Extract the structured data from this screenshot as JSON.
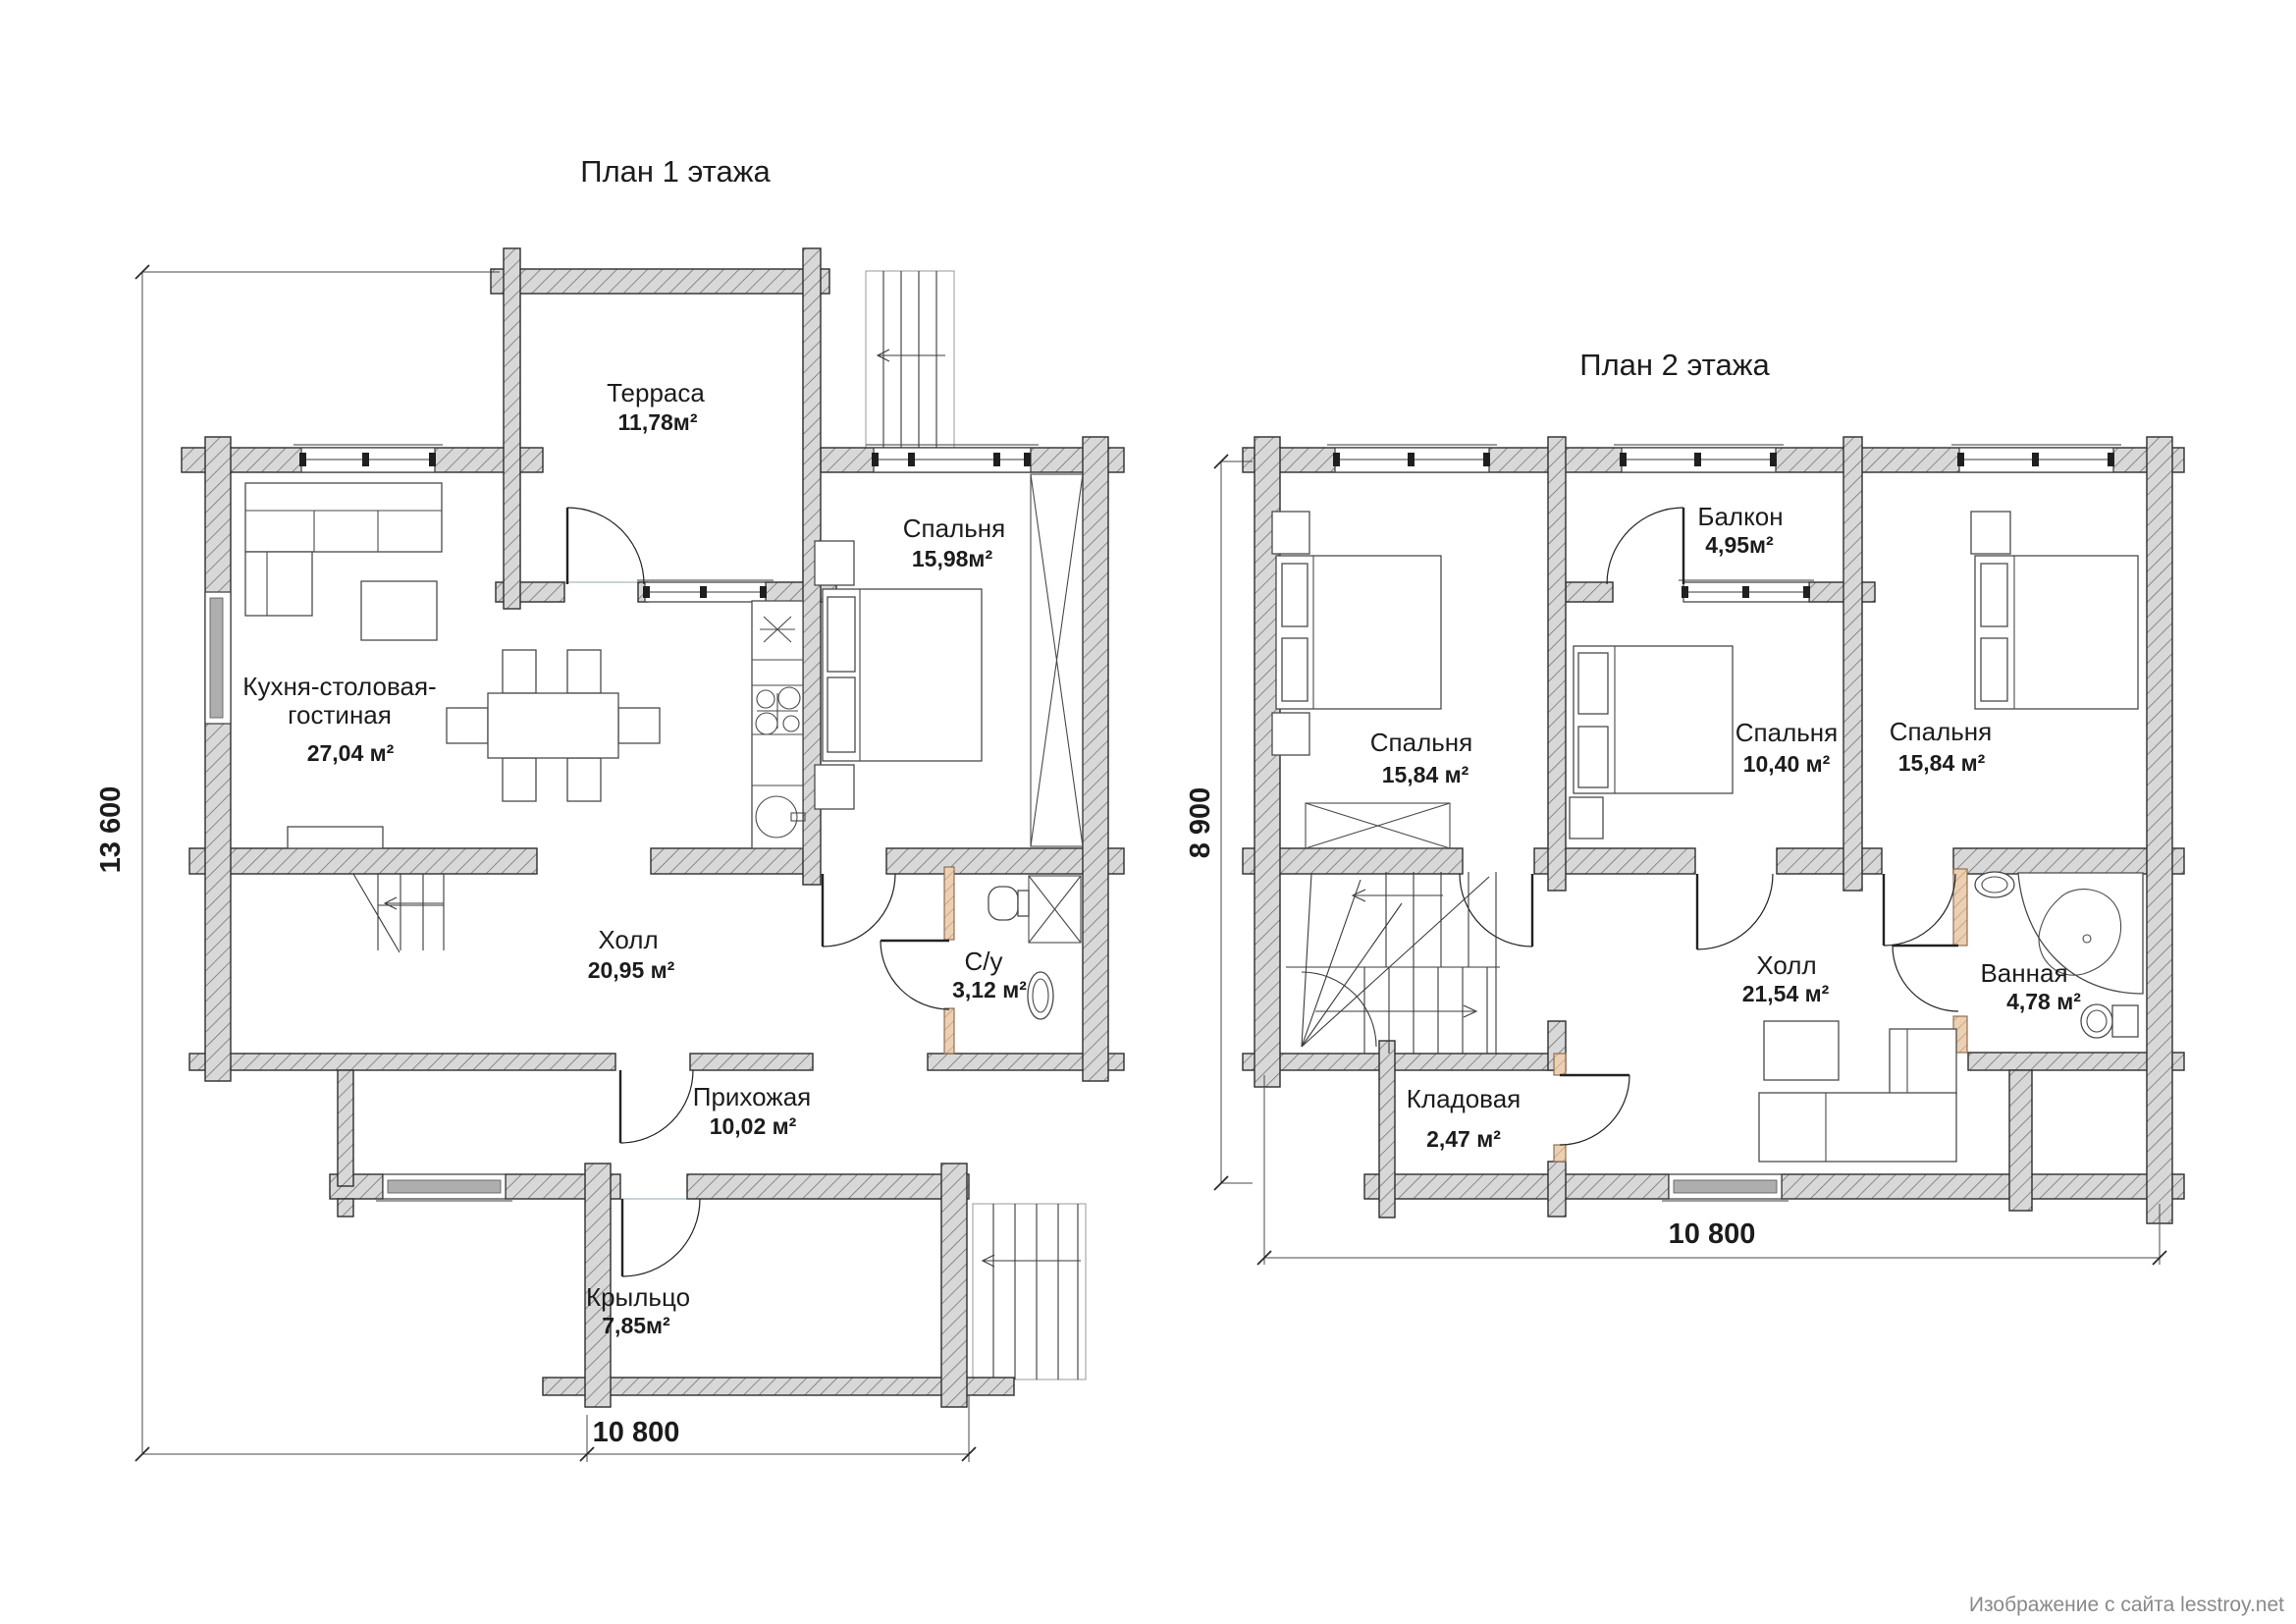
{
  "document": {
    "watermark": "Изображение с сайта lesstroy.net"
  },
  "floor1": {
    "title": "План 1 этажа",
    "rooms": {
      "terrace": {
        "name": "Терраса",
        "area": "11,78м²"
      },
      "bedroom": {
        "name": "Спальня",
        "area": "15,98м²"
      },
      "kitchen": {
        "name_line1": "Кухня-столовая-",
        "name_line2": "гостиная",
        "area": "27,04 м²"
      },
      "hall": {
        "name": "Холл",
        "area": "20,95 м²"
      },
      "wc": {
        "name": "С/у",
        "area": "3,12 м²"
      },
      "entry": {
        "name": "Прихожая",
        "area": "10,02 м²"
      },
      "porch": {
        "name": "Крыльцо",
        "area": "7,85м²"
      }
    },
    "dimensions": {
      "height": "13 600",
      "width": "10 800"
    }
  },
  "floor2": {
    "title": "План 2 этажа",
    "rooms": {
      "balcony": {
        "name": "Балкон",
        "area": "4,95м²"
      },
      "bedroom_left": {
        "name": "Спальня",
        "area": "15,84 м²"
      },
      "bedroom_mid": {
        "name": "Спальня",
        "area": "10,40 м²"
      },
      "bedroom_right": {
        "name": "Спальня",
        "area": "15,84 м²"
      },
      "hall": {
        "name": "Холл",
        "area": "21,54 м²"
      },
      "bath": {
        "name": "Ванная",
        "area": "4,78 м²"
      },
      "storage": {
        "name": "Кладовая",
        "area": "2,47 м²"
      }
    },
    "dimensions": {
      "height": "8 900",
      "width": "10 800"
    }
  }
}
